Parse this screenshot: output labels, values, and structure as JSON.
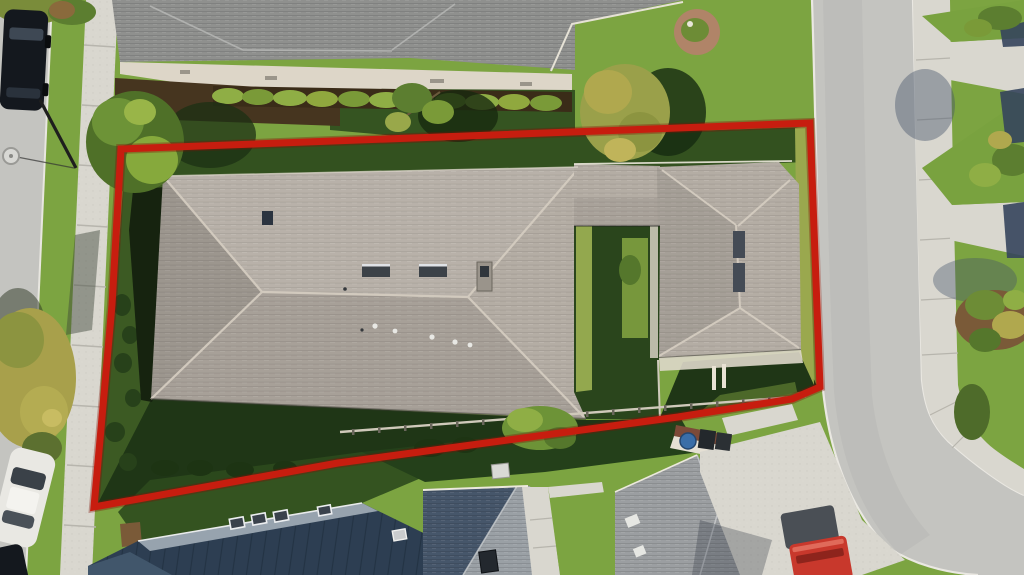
{
  "scene": {
    "type": "aerial-drone-photo",
    "subject": "single-family home lot outlined with red property boundary",
    "setting": "suburban residential street, top-down view"
  },
  "annotation": {
    "label": "property-boundary",
    "color": "#c71d0f",
    "underglow": "#7d1007",
    "stroke_width": 7,
    "points": "121,149 810,123 820,387 792,399 678,417 338,463 94,507 112,305"
  },
  "colors": {
    "grass_base": "#7ca441",
    "grass_dark": "#2c4a1d",
    "grass_deep_shadow": "#1f3616",
    "asphalt": "#c4c4c0",
    "concrete": "#d9d7cf",
    "roof_main": "#b4ada4",
    "roof_neighbor": "#8f908e",
    "roof_slate_dark": "#2d3e52",
    "roof_slate_light": "#97a3ae",
    "roof_blue_dark": "#46566a",
    "roof_blue_light": "#9aa0a5",
    "roof_gray": "#9b9ea1",
    "truck_red": "#c8382c",
    "car_white": "#e9e8e3",
    "car_dark": "#14181e",
    "mulch": "#7a5a38",
    "courtyard_sun": "#93a84e"
  },
  "objects": {
    "vehicles": [
      "dark SUV parked on left street",
      "white sedan parked on left street",
      "dark car at bottom-left corner",
      "red pickup truck on bottom-right driveway"
    ],
    "street_furniture": [
      "street lamp top-left"
    ],
    "landscape": [
      "large green tree at boundary corner",
      "yellow tree on left verge",
      "yellow-green tree top-center-right",
      "hedge row behind neighbor house",
      "mulch planting island right of road"
    ]
  }
}
